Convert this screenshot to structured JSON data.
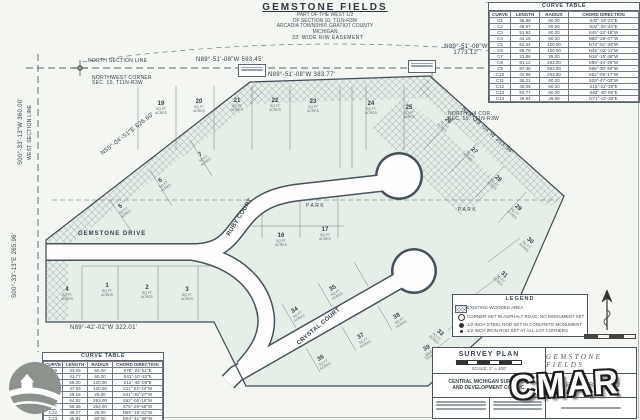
{
  "title": {
    "name": "GEMSTONE FIELDS",
    "line1": "PART OF THE WEST 1/2",
    "line2": "OF SECTION 10, T11N-R3W",
    "line3": "ARCADIA TOWNSHIP, GRATIOT COUNTY",
    "line4": "MICHIGAN",
    "easement_note": "33' WIDE R/W EASEMENT"
  },
  "section_labels": {
    "north_section_line": "NORTH SECTION LINE",
    "west_section_line": "WEST SECTION LINE",
    "nw_corner_1": "NORTHWEST CORNER",
    "nw_corner_2": "SEC. 10, T11N-R3W",
    "north_quarter_1": "NORTH 1/4 COR.",
    "north_quarter_2": "SEC. 10, T11N-R3W"
  },
  "bearings": {
    "top_left": "N89°-51'-08\"W  593.45'",
    "top_center": "N89°-51'-08\"W  383.77'",
    "top_right_1": "N89°-51'-08\"W",
    "top_right_2": "1773.12'",
    "west_upper": "S00°-33'-13\"W  360.00'",
    "west_lower": "S00°-33'-13\"E  265.96'",
    "nw_diagonal": "N55°-04'-51\"E  626.60'",
    "ne_diagonal": "N40°-28'-04\"W  353.94'",
    "south": "N89°-42'-02\"W  322.01'"
  },
  "streets": {
    "gemstone_drive": "GEMSTONE DRIVE",
    "ruby_court": "RUBY COURT",
    "crystal_court": "CRYSTAL COURT",
    "park_west": "PARK",
    "park_east": "PARK"
  },
  "lot_sub": {
    "line1": "SQ FT",
    "line2": "ACRES"
  },
  "lots": [
    "1",
    "2",
    "3",
    "4",
    "5",
    "6",
    "7",
    "16",
    "17",
    "19",
    "20",
    "21",
    "22",
    "23",
    "24",
    "25",
    "26",
    "27",
    "28",
    "29",
    "30",
    "31",
    "32",
    "33",
    "34",
    "35",
    "36",
    "37",
    "38",
    "39"
  ],
  "curve_table_right": {
    "title": "CURVE TABLE",
    "headers": [
      "CURVE",
      "LENGTH",
      "RADIUS",
      "CHORD DIRECTION"
    ],
    "rows": [
      [
        "C1",
        "35.89",
        "60.00",
        "S42°-18'-22\"E"
      ],
      [
        "C2",
        "48.67",
        "60.00",
        "S02°-25'-40\"E"
      ],
      [
        "C3",
        "51.92",
        "60.00",
        "S45°-33'-18\"W"
      ],
      [
        "C4",
        "44.15",
        "60.00",
        "N88°-29'-07\"W"
      ],
      [
        "C5",
        "62.34",
        "120.00",
        "N74°-51'-33\"W"
      ],
      [
        "C6",
        "58.70",
        "120.00",
        "N46°-02'-11\"W"
      ],
      [
        "C7",
        "23.56",
        "25.00",
        "N18°-15'-48\"W"
      ],
      [
        "C8",
        "91.12",
        "263.00",
        "S85°-44'-26\"W"
      ],
      [
        "C9",
        "87.45",
        "263.00",
        "S66°-30'-54\"W"
      ],
      [
        "C10",
        "42.88",
        "263.00",
        "S52°-09'-17\"W"
      ],
      [
        "C11",
        "36.21",
        "60.00",
        "S29°-47'-02\"W"
      ],
      [
        "C12",
        "49.05",
        "60.00",
        "S16°-22'-39\"E"
      ],
      [
        "C13",
        "53.77",
        "60.00",
        "S63°-40'-55\"E"
      ],
      [
        "C14",
        "28.94",
        "25.00",
        "N71°-13'-28\"E"
      ]
    ]
  },
  "curve_table_left": {
    "title": "CURVE TABLE",
    "headers": [
      "CURVE",
      "LENGTH",
      "RADIUS",
      "CHORD DIRECTION"
    ],
    "rows": [
      [
        "C15",
        "33.08",
        "60.00",
        "S78°-24'-51\"E"
      ],
      [
        "C16",
        "41.77",
        "60.00",
        "S41°-10'-33\"E"
      ],
      [
        "C17",
        "55.20",
        "120.00",
        "S12°-45'-09\"E"
      ],
      [
        "C18",
        "47.63",
        "120.00",
        "S11°-52'-44\"W"
      ],
      [
        "C19",
        "26.18",
        "25.00",
        "S41°-30'-27\"W"
      ],
      [
        "C20",
        "64.92",
        "263.00",
        "S62°-05'-16\"W"
      ],
      [
        "C21",
        "58.36",
        "263.00",
        "S75°-29'-58\"W"
      ],
      [
        "C22",
        "39.27",
        "25.00",
        "N59°-18'-02\"W"
      ],
      [
        "C23",
        "45.81",
        "60.00",
        "N24°-41'-36\"W"
      ],
      [
        "C24",
        "52.44",
        "60.00",
        "N21°-57'-13\"E"
      ]
    ]
  },
  "legend": {
    "title": "LEGEND",
    "woodland": "EXISTING WOODED AREA",
    "item2": "CORNER SET IN ASPHALT ROAD, NO MONUMENT SET",
    "item3": "1/2 INCH STEEL ROD SET IN CONCRETE MONUMENT",
    "item4": "1/2 INCH IRON ROD SET AT ALL LOT CORNERS"
  },
  "title_block": {
    "survey_plan": "SURVEY PLAN",
    "scale_note": "SCALE: 1\" = 100'",
    "firm_1": "CENTRAL MICHIGAN SURVEYING",
    "firm_2": "AND DEVELOPMENT CO., INC.",
    "project": "GEMSTONE FIELDS",
    "date": "SEPTEMBER 2002"
  },
  "watermark": "CMAR"
}
